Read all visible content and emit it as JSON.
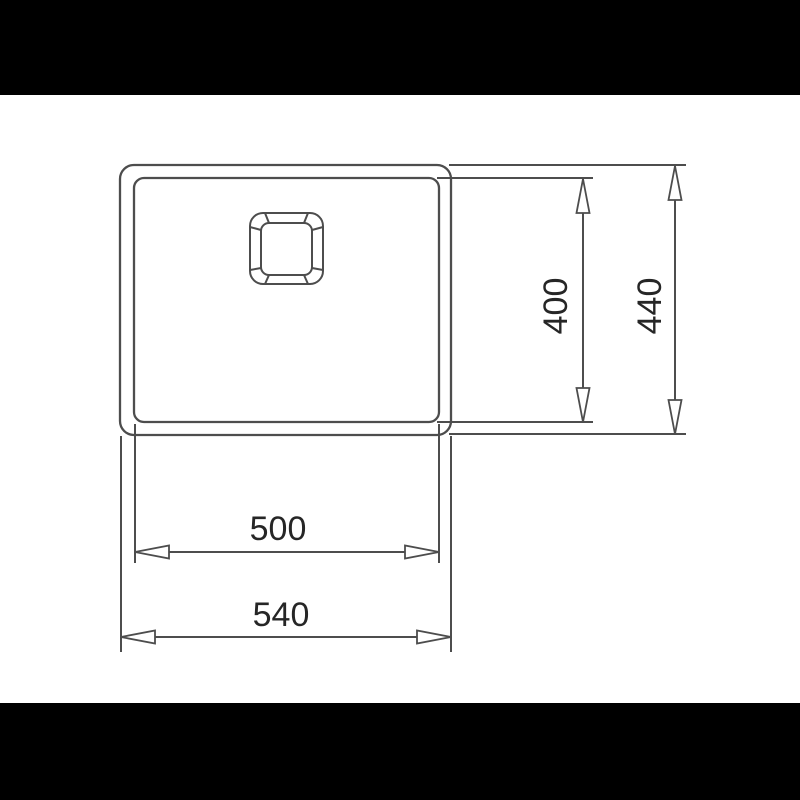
{
  "scene": {
    "background": "#ffffff",
    "letterbox_color": "#000000",
    "line_color": "#4d4d4d",
    "text_color": "#262626"
  },
  "drawing": {
    "type": "technical-dimension-drawing",
    "subject": "sink-bowl-top-view",
    "dimensions": [
      {
        "id": "inner-height",
        "label": "400",
        "orientation": "vertical"
      },
      {
        "id": "outer-height",
        "label": "440",
        "orientation": "vertical"
      },
      {
        "id": "inner-width",
        "label": "500",
        "orientation": "horizontal"
      },
      {
        "id": "outer-width",
        "label": "540",
        "orientation": "horizontal"
      }
    ]
  }
}
